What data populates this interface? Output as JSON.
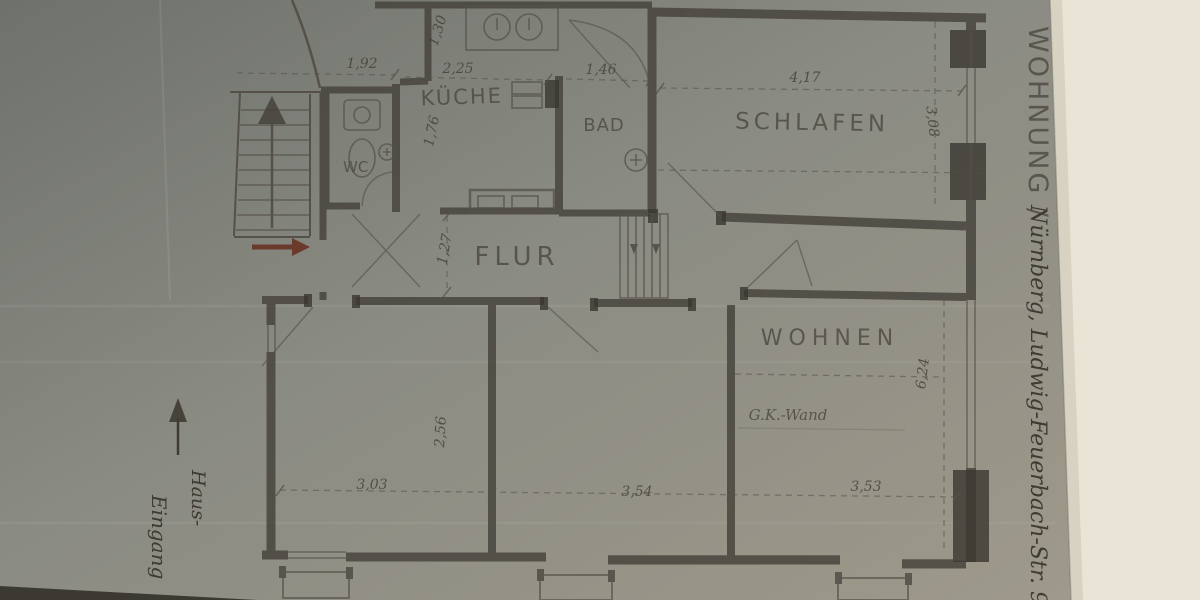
{
  "photo": {
    "description": "Hand-drawn apartment floor plan, pencil on grey-green paper, photographed on a cream surface",
    "colors": {
      "backdrop": "#eae4d7",
      "paper_dark": "#6e726b",
      "paper_mid": "#8a8b83",
      "paper_light": "#9e998a",
      "pencil": "#4a463e",
      "wall": "#3f3c35",
      "entry_arrow": "#6a3a2b"
    }
  },
  "side_note": {
    "title": "WOHNUNG /",
    "address": "Nürnberg, Ludwig-Feuerbach-Str. 96"
  },
  "rooms": {
    "wc": "WC",
    "kueche": "KÜCHE",
    "bad": "BAD",
    "schlafen": "SCHLAFEN",
    "flur": "FLUR",
    "wohnen": "WOHNEN"
  },
  "annotations": {
    "gk_wand": "G.K.-Wand",
    "haus_eingang_line1": "Haus-",
    "haus_eingang_line2": "Eingang"
  },
  "dimensions": {
    "stair_wc_width": "1,92",
    "kueche_niche_width": "1,30",
    "kueche_width": "2,25",
    "kueche_depth": "1,76",
    "bad_door_width": "1,46",
    "schlafen_width": "4,17",
    "schlafen_depth": "3,08",
    "flur_depth": "1,27",
    "zimmer1_width": "3,03",
    "zimmer1_depth": "2,56",
    "zimmer2_width": "3,54",
    "wohnen_width": "3,53",
    "wohnen_depth": "6,24"
  }
}
